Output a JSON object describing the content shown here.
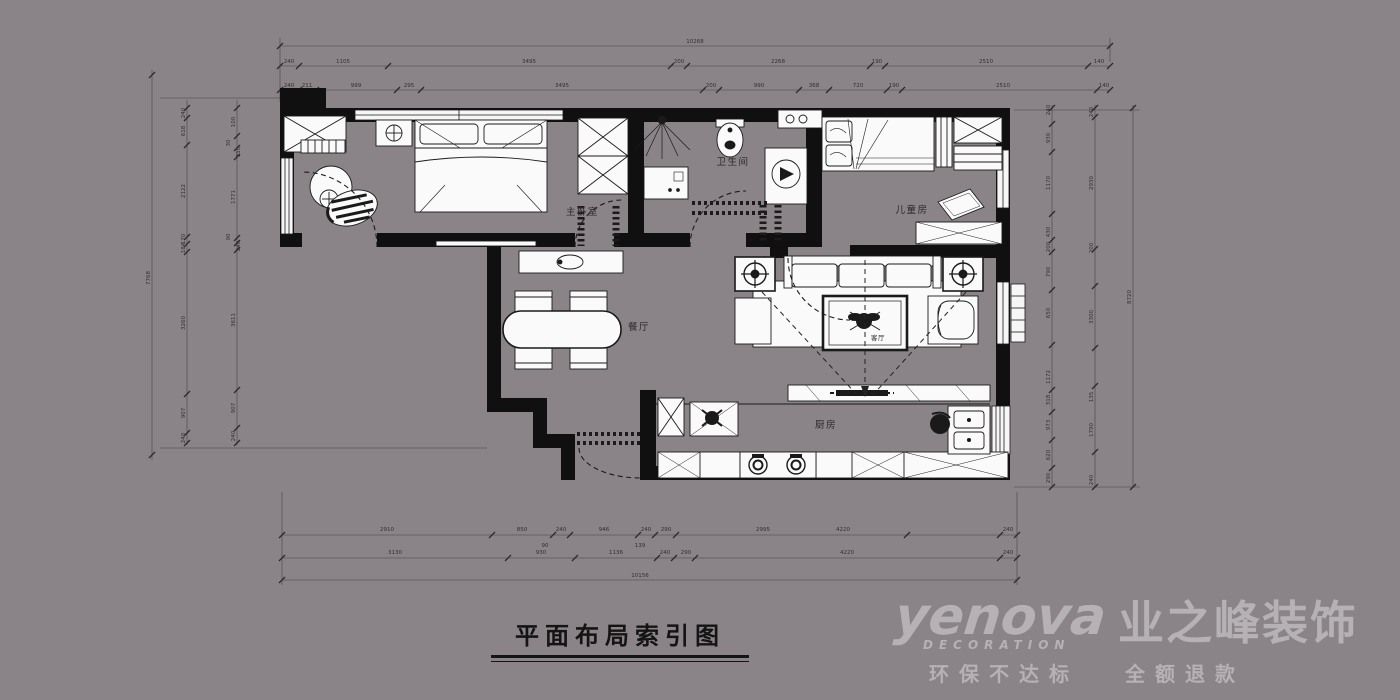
{
  "colors": {
    "background": "#8a8488",
    "walls": "#101010",
    "furniture_fill": "#fafafa",
    "dimension_lines": "#3a3739",
    "logo_text": "#b6b1b4",
    "title_text": "#141414"
  },
  "title": "平面布局索引图",
  "rooms": {
    "master_bedroom": "主卧室",
    "bathroom": "卫生间",
    "kids_room": "儿童房",
    "dining_room": "餐厅",
    "kitchen": "厨房",
    "living_room": "客厅"
  },
  "logo": {
    "brand": "yenova",
    "subtitle": "DECORATION",
    "company": "业之峰装饰",
    "tagline_left": "环保不达标",
    "tagline_right": "全额退款"
  },
  "dims": {
    "top": {
      "overall": "10268",
      "row2": [
        "240",
        "1105",
        "3495",
        "200",
        "2268",
        "190",
        "2510",
        "140"
      ],
      "row3": [
        "240",
        "211",
        "999",
        "295",
        "3495",
        "200",
        "990",
        "368",
        "720",
        "190",
        "2510",
        "140"
      ]
    },
    "bottom": {
      "row1": [
        "2910",
        "850",
        "240",
        "946",
        "240",
        "290",
        "2995",
        "4220",
        "240"
      ],
      "row1_sub": [
        "90",
        "139"
      ],
      "row2": [
        "3130",
        "930",
        "1136",
        "240",
        "290",
        "4220",
        "240"
      ],
      "overall": "10156"
    },
    "left": {
      "outer": [
        "240",
        "618",
        "2122",
        "170",
        "184",
        "3260",
        "907",
        "240"
      ],
      "inner": [
        "100",
        "30",
        "310",
        "1771",
        "90",
        "240",
        "3611",
        "907",
        "240"
      ],
      "overall": "7768"
    },
    "right": {
      "inner": [
        "240",
        "930",
        "1170",
        "430",
        "200",
        "790",
        "650",
        "1172",
        "318",
        "973",
        "620",
        "290"
      ],
      "mid": [
        "240",
        "2930",
        "200",
        "3300",
        "135",
        "1790",
        "240"
      ],
      "overall": "8720"
    }
  }
}
